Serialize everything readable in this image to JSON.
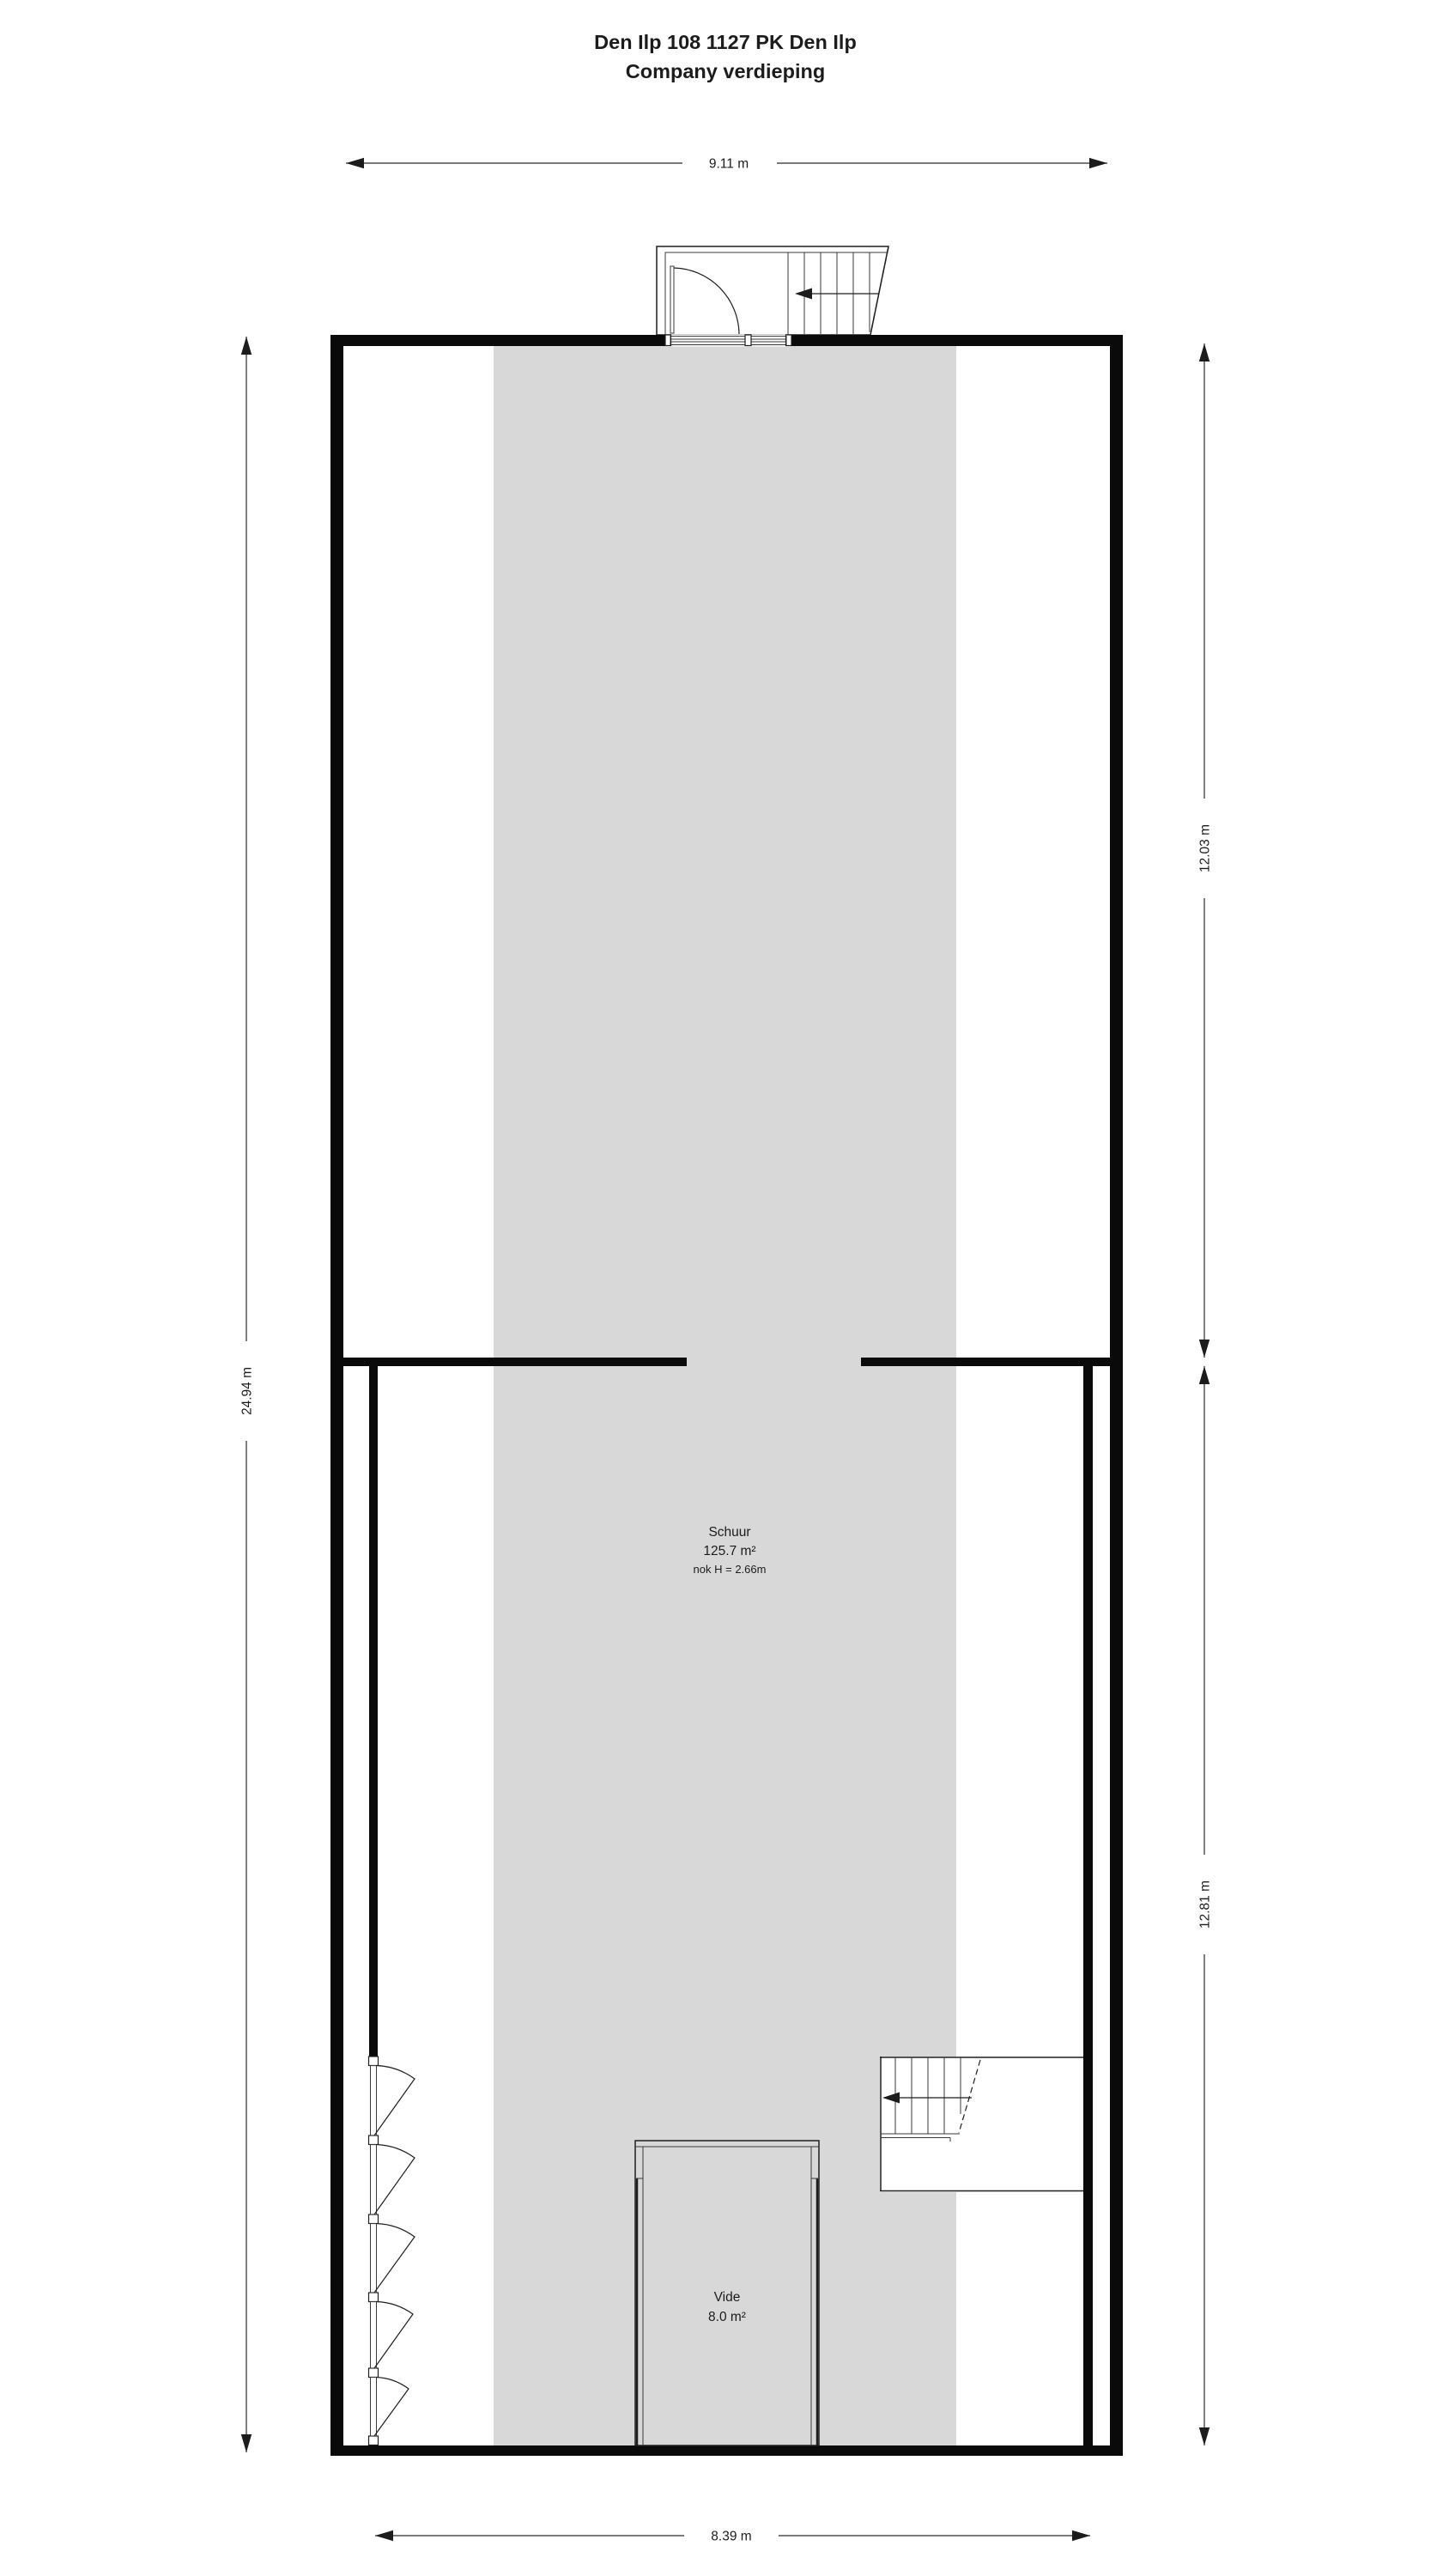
{
  "title": {
    "line1": "Den Ilp 108 1127 PK Den Ilp",
    "line2": "Company verdieping"
  },
  "dimensions": {
    "top": "9.11 m",
    "left": "24.94 m",
    "right_upper": "12.03 m",
    "right_lower": "12.81 m",
    "bottom": "8.39 m"
  },
  "rooms": {
    "schuur": {
      "name": "Schuur",
      "area": "125.7 m²",
      "ridge_height": "nok H = 2.66m"
    },
    "vide": {
      "name": "Vide",
      "area": "8.0 m²"
    }
  },
  "colors": {
    "wall": "#0a0a0a",
    "band": "#d8d8d8",
    "entry_fill": "#d3d3d3"
  }
}
